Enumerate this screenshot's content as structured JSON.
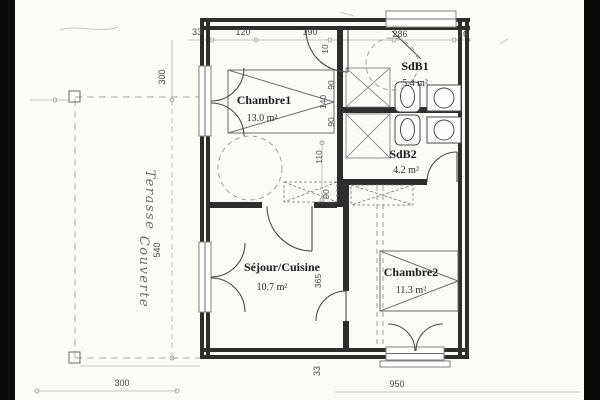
{
  "title": "Floor plan scan",
  "colors": {
    "paper": "#fbfbf8",
    "scan_border": "#0b0b0b",
    "wall": "#2e2e2c",
    "ink": "#4a4a4a",
    "dim_text": "#4a4a4a",
    "light_line": "#b3b3b3"
  },
  "rooms": [
    {
      "name": "Chambre1",
      "area": "13.0 m²"
    },
    {
      "name": "SdB1",
      "area": "5.4 m²"
    },
    {
      "name": "SdB2",
      "area": "4.2 m²"
    },
    {
      "name": "Séjour/Cuisine",
      "area": "10.7 m²"
    },
    {
      "name": "Chambre2",
      "area": "11.3 m²"
    }
  ],
  "terrace": {
    "line1": "Terasse",
    "line2": "Couverte"
  },
  "dimensions": {
    "top": [
      "33",
      "120",
      "190",
      "286",
      "16"
    ],
    "left": [
      "300",
      "540"
    ],
    "bottom": [
      "300",
      "33",
      "950"
    ],
    "interior": [
      "10",
      "90",
      "140",
      "90",
      "110",
      "90",
      "365"
    ]
  }
}
